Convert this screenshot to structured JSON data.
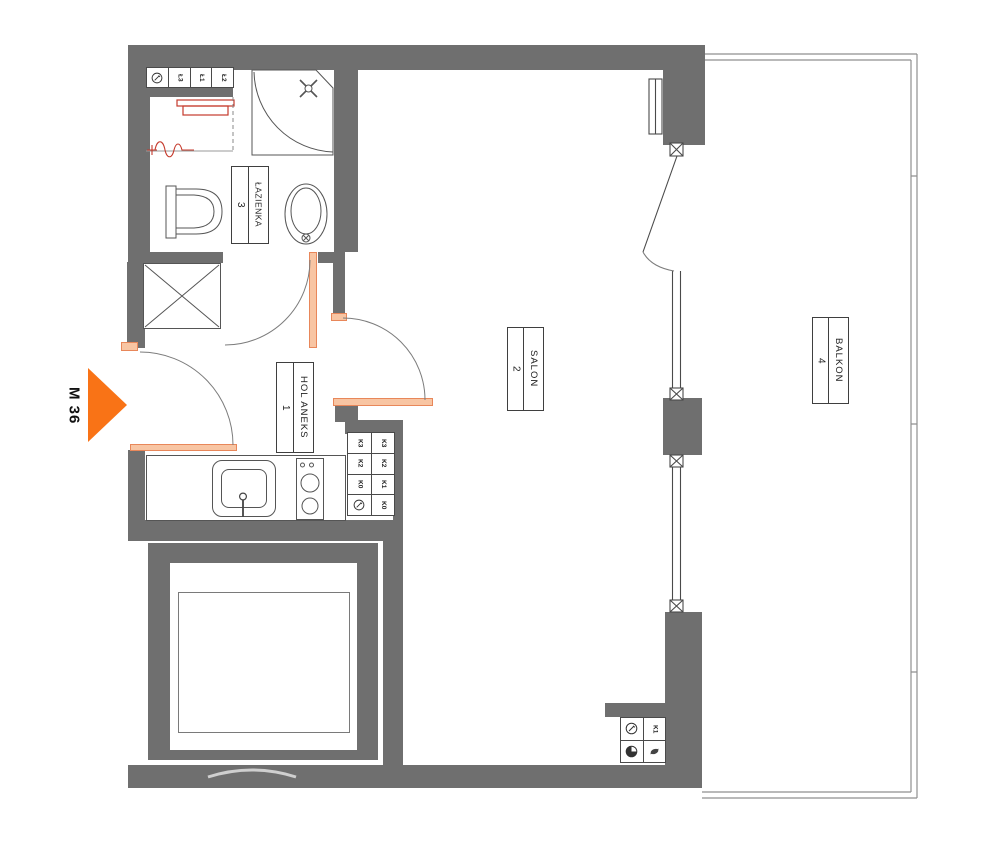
{
  "plan": {
    "unit_label": "M 36",
    "rooms": {
      "hol": {
        "name": "HOL ANEKS",
        "number": "1"
      },
      "salon": {
        "name": "SALON",
        "number": "2"
      },
      "lazienka": {
        "name": "ŁAZIENKA",
        "number": "3"
      },
      "balkon": {
        "name": "BALKON",
        "number": "4"
      }
    },
    "points": {
      "bathroom_row": [
        "Ł3",
        "Ł1",
        "Ł2"
      ],
      "kitchen_grid": [
        [
          "K3",
          "K3"
        ],
        [
          "K2",
          "K2"
        ],
        [
          "K0",
          "K1"
        ],
        [
          "",
          "K0"
        ]
      ],
      "balcony_k1": "K1"
    },
    "colors": {
      "wall_gray": "#6f6f6f",
      "arrow_orange": "#f97316",
      "new_wall_orange": "#f8c5a3",
      "fixture_red": "#c53a2c"
    }
  }
}
